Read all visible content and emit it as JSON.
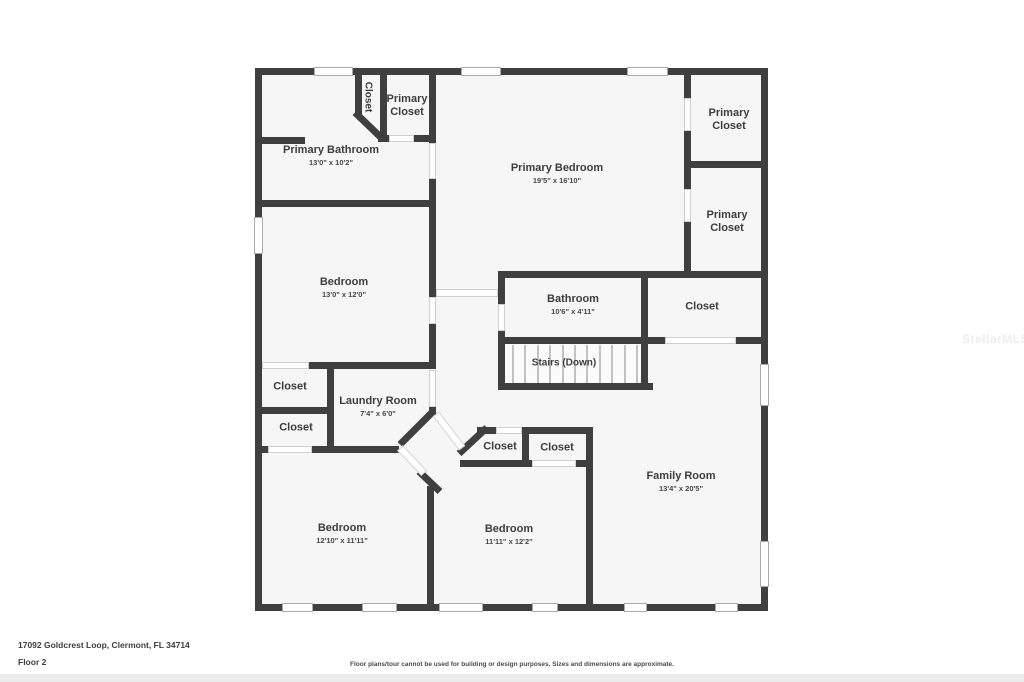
{
  "address": "17092 Goldcrest Loop, Clermont, FL 34714",
  "floor_label": "Floor 2",
  "disclaimer": "Floor plans/tour cannot be used for building or design purposes. Sizes and dimensions are approximate.",
  "watermark": "StellarMLS",
  "colors": {
    "wall": "#3f3f3f",
    "room_fill": "#f6f6f6",
    "text": "#3d3d3d",
    "page_bg": "#ffffff",
    "footer_strip": "#ececec"
  },
  "rooms": [
    {
      "name": "Closet"
    },
    {
      "name": "Primary Closet"
    },
    {
      "name": "Primary Bathroom",
      "dims": "13'0\" x 10'2\""
    },
    {
      "name": "Primary Bedroom",
      "dims": "19'5\" x 16'10\""
    },
    {
      "name": "Primary Closet"
    },
    {
      "name": "Primary Closet"
    },
    {
      "name": "Bedroom",
      "dims": "13'0\" x 12'0\""
    },
    {
      "name": "Bathroom",
      "dims": "10'6\" x 4'11\""
    },
    {
      "name": "Closet"
    },
    {
      "name": "Stairs (Down)"
    },
    {
      "name": "Closet"
    },
    {
      "name": "Closet"
    },
    {
      "name": "Laundry Room",
      "dims": "7'4\" x 6'0\""
    },
    {
      "name": "Closet"
    },
    {
      "name": "Closet"
    },
    {
      "name": "Family Room",
      "dims": "13'4\" x 20'5\""
    },
    {
      "name": "Bedroom",
      "dims": "12'10\" x 11'11\""
    },
    {
      "name": "Bedroom",
      "dims": "11'11\" x 12'2\""
    }
  ]
}
